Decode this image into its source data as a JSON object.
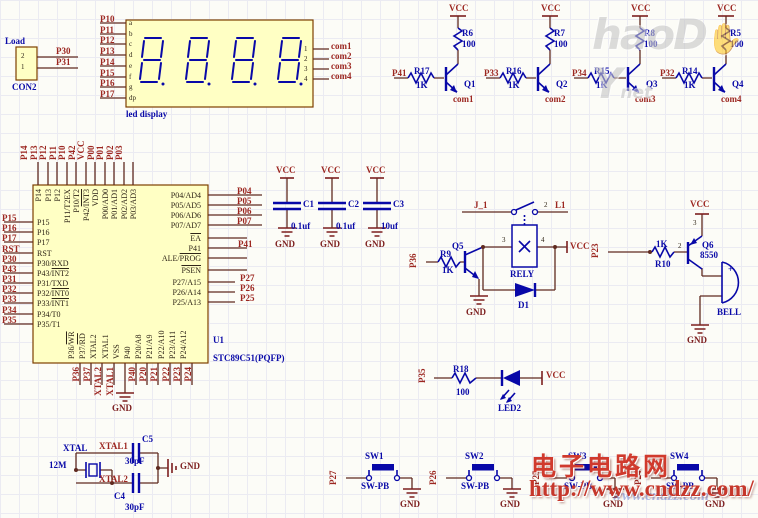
{
  "power": {
    "vcc": "VCC",
    "gnd": "GND"
  },
  "watermarks": {
    "logo": {
      "part1": "haoD",
      "hand": "✋",
      "part2": "Y",
      "suffix": "net"
    },
    "site_name": "电子电路网",
    "site_url": "http://www.cndzz.com/",
    "site_url_faint": "www.cndzz.com"
  },
  "con2": {
    "label": "Load",
    "designator": "CON2",
    "pins": [
      "2",
      "1"
    ],
    "nets": [
      "P30",
      "P31"
    ]
  },
  "display": {
    "caption": "led display",
    "left_nets": [
      "P10",
      "P11",
      "P12",
      "P13",
      "P14",
      "P15",
      "P16",
      "P17"
    ],
    "seg_pins": [
      "a",
      "b",
      "c",
      "d",
      "e",
      "f",
      "g",
      "dp"
    ],
    "digit_pins": [
      "1",
      "2",
      "3",
      "4"
    ],
    "right_nets": [
      "com1",
      "com2",
      "com3",
      "com4"
    ]
  },
  "drivers": [
    {
      "in": "P41",
      "rb": "R17",
      "rbv": "1K",
      "rc": "R6",
      "rcv": "100",
      "q": "Q1",
      "out": "com1"
    },
    {
      "in": "P33",
      "rb": "R16",
      "rbv": "1K",
      "rc": "R7",
      "rcv": "100",
      "q": "Q2",
      "out": "com2"
    },
    {
      "in": "P34",
      "rb": "R15",
      "rbv": "1K",
      "rc": "R8",
      "rcv": "100",
      "q": "Q3",
      "out": "com3"
    },
    {
      "in": "P32",
      "rb": "R14",
      "rbv": "1K",
      "rc": "R5",
      "rcv": "100",
      "q": "Q4",
      "out": "com4"
    }
  ],
  "mcu": {
    "designator": "U1",
    "part": "STC89C51(PQFP)",
    "top": [
      {
        "ext": "P14",
        "p": "P14"
      },
      {
        "ext": "P13",
        "p": "P13"
      },
      {
        "ext": "P12",
        "p": "P12"
      },
      {
        "ext": "P11",
        "p": "P11/T2EX"
      },
      {
        "ext": "P10",
        "p": "P10/T2"
      },
      {
        "ext": "P42",
        "p": "P42/",
        "b": "INT3"
      },
      {
        "ext": "VCC",
        "p": "VDD"
      },
      {
        "ext": "P00",
        "p": "P00/AD0"
      },
      {
        "ext": "P01",
        "p": "P01/AD1"
      },
      {
        "ext": "P02",
        "p": "P02/AD2"
      },
      {
        "ext": "P03",
        "p": "P03/AD3"
      }
    ],
    "left": [
      {
        "ext": "P15",
        "p": "P15"
      },
      {
        "ext": "P16",
        "p": "P16"
      },
      {
        "ext": "P17",
        "p": "P17"
      },
      {
        "ext": "RST",
        "p": "RST"
      },
      {
        "ext": "P30",
        "p": "P30/RXD"
      },
      {
        "ext": "P43",
        "p": "P43/",
        "b": "INT2"
      },
      {
        "ext": "P31",
        "p": "P31/TXD"
      },
      {
        "ext": "P32",
        "p": "P32/",
        "b": "INT0"
      },
      {
        "ext": "P33",
        "p": "P33/",
        "b": "INT1"
      },
      {
        "ext": "P34",
        "p": "P34/T0"
      },
      {
        "ext": "P35",
        "p": "P35/T1"
      }
    ],
    "right": [
      {
        "ext": "P04",
        "p": "P04/AD4"
      },
      {
        "ext": "P05",
        "p": "P05/AD5"
      },
      {
        "ext": "P06",
        "p": "P06/AD6"
      },
      {
        "ext": "P07",
        "p": "P07/AD7"
      },
      {
        "b": "EA"
      },
      {
        "ext": "P41",
        "p": "P41"
      },
      {
        "p": "ALE/",
        "b": "PROG"
      },
      {
        "b": "PSEN"
      },
      {
        "ext": "P27",
        "p": "P27/A15"
      },
      {
        "ext": "P26",
        "p": "P26/A14"
      },
      {
        "ext": "P25",
        "p": "P25/A13"
      }
    ],
    "bottom": [
      {
        "ext": "P36",
        "p": "P36/",
        "b": "WR"
      },
      {
        "ext": "P37",
        "p": "P37/",
        "b": "RD"
      },
      {
        "ext": "XTAL2",
        "p": "XTAL2"
      },
      {
        "ext": "XTAL1",
        "p": "XTAL1"
      },
      {
        "p": "VSS"
      },
      {
        "ext": "P40",
        "p": "P40"
      },
      {
        "ext": "P20",
        "p": "P20/A8"
      },
      {
        "ext": "P21",
        "p": "P21/A9"
      },
      {
        "ext": "P22",
        "p": "P22/A10"
      },
      {
        "ext": "P23",
        "p": "P23/A11"
      },
      {
        "ext": "P24",
        "p": "P24/A12"
      }
    ]
  },
  "caps": {
    "items": [
      {
        "d": "C1",
        "v": "0.1uf"
      },
      {
        "d": "C2",
        "v": "0.1uf"
      },
      {
        "d": "C3",
        "v": "10uf"
      }
    ]
  },
  "relay": {
    "net_in": "P36",
    "rb": "R9",
    "rbv": "1K",
    "q": "Q5",
    "pin3": "3",
    "pin4": "4",
    "box": "RELY",
    "diode": "D1",
    "sw_left": "J_1",
    "sw_pin2": "2",
    "sw_right": "L1"
  },
  "bell": {
    "net_in": "P23",
    "r": "R10",
    "rv": "1K",
    "pin2": "2",
    "pin3": "3",
    "q": "Q6",
    "qv": "8550",
    "plus": "+",
    "label": "BELL"
  },
  "led2": {
    "net_in": "P35",
    "r": "R18",
    "rv": "100",
    "d": "LED2"
  },
  "xtal": {
    "label": "XTAL",
    "value": "12M",
    "n1": "XTAL1",
    "n2": "XTAL2",
    "c_top": "C5",
    "c_top_v": "30pF",
    "c_bot": "C4",
    "c_bot_v": "30pF"
  },
  "switches": {
    "type_label": "SW-PB",
    "items": [
      {
        "net": "P27",
        "d": "SW1"
      },
      {
        "net": "P26",
        "d": "SW2"
      },
      {
        "net": "P25",
        "d": "SW3"
      },
      {
        "net": "P24",
        "d": "SW4"
      }
    ]
  },
  "colors": {
    "wire": "#5f2a20",
    "symbol": "#0808a8",
    "net_label": "#9c2721",
    "designator": "#0a0aa8",
    "power": "#7d1f1f",
    "part_fill": "#ffffc4",
    "part_border": "#7d3f00",
    "watermark_red": "#d03a2d",
    "watermark_gray": "#c6c6c6"
  }
}
